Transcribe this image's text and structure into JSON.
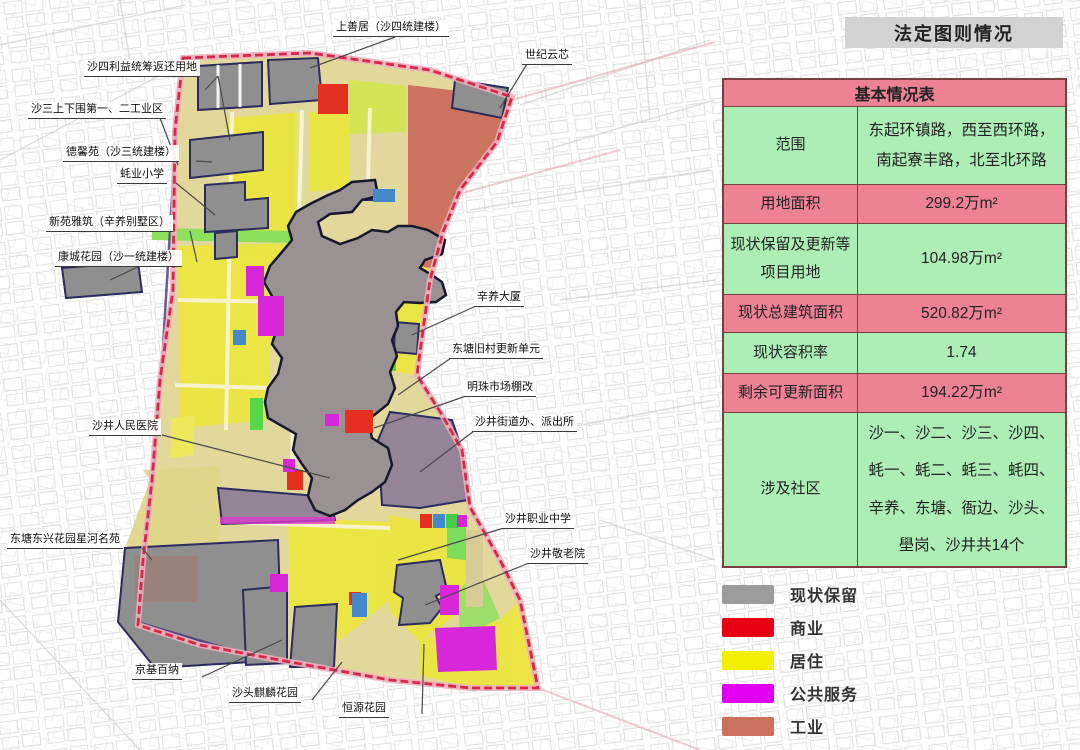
{
  "title": {
    "text": "法定图则情况"
  },
  "table": {
    "header": "基本情况表",
    "rows": [
      {
        "label": "范围",
        "value": "东起环镇路，西至西环路，南起寮丰路，北至北环路",
        "tone": "green"
      },
      {
        "label": "用地面积",
        "value": "299.2万m²",
        "tone": "pink"
      },
      {
        "label": "现状保留及更新等项目用地",
        "value": "104.98万m²",
        "tone": "green"
      },
      {
        "label": "现状总建筑面积",
        "value": "520.82万m²",
        "tone": "pink"
      },
      {
        "label": "现状容积率",
        "value": "1.74",
        "tone": "green"
      },
      {
        "label": "剩余可更新面积",
        "value": "194.22万m²",
        "tone": "pink"
      },
      {
        "label": "涉及社区",
        "value": "沙一、沙二、沙三、沙四、蚝一、蚝二、蚝三、蚝四、辛养、东塘、衙边、沙头、壆岗、沙井共14个",
        "tone": "green"
      }
    ],
    "colors": {
      "pink": "#ee8295",
      "green": "#aceeb5",
      "border": "#7a4040"
    }
  },
  "legend": {
    "items": [
      {
        "label": "现状保留",
        "color": "#9c9c9c"
      },
      {
        "label": "商业",
        "color": "#e60012"
      },
      {
        "label": "居住",
        "color": "#f2f000"
      },
      {
        "label": "公共服务",
        "color": "#e100f1"
      },
      {
        "label": "工业",
        "color": "#c9705e"
      }
    ]
  },
  "map": {
    "boundary_color": "#d5294a",
    "labels": [
      {
        "text": "上善居（沙四统建楼）"
      },
      {
        "text": "沙四利益统筹返还用地"
      },
      {
        "text": "世纪云芯"
      },
      {
        "text": "沙三上下围第一、二工业区"
      },
      {
        "text": "德馨苑（沙三统建楼）"
      },
      {
        "text": "蚝业小学"
      },
      {
        "text": "新苑雅筑（辛养别墅区）"
      },
      {
        "text": "康城花园（沙一统建楼）"
      },
      {
        "text": "辛养大厦"
      },
      {
        "text": "东塘旧村更新单元"
      },
      {
        "text": "明珠市场棚改"
      },
      {
        "text": "沙井街道办、派出所"
      },
      {
        "text": "沙井人民医院"
      },
      {
        "text": "沙井职业中学"
      },
      {
        "text": "沙井敬老院"
      },
      {
        "text": "东塘东兴花园星河名苑"
      },
      {
        "text": "京基百纳"
      },
      {
        "text": "沙头麒麟花园"
      },
      {
        "text": "恒源花园"
      }
    ]
  }
}
